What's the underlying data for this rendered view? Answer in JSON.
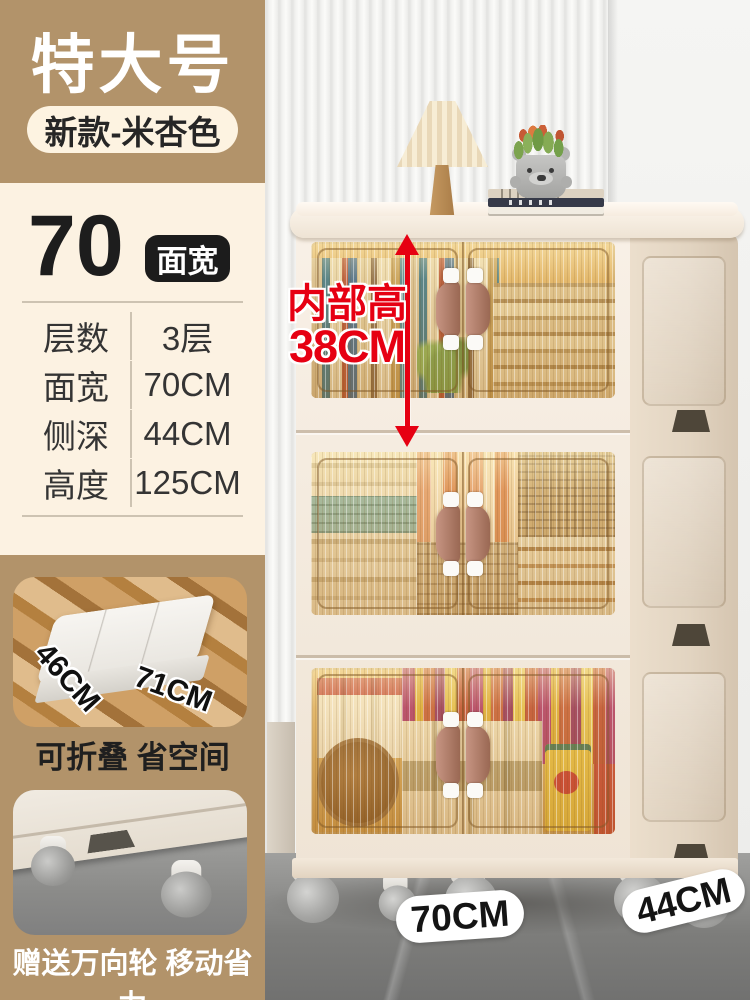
{
  "panel": {
    "size_label": "特大号",
    "variant_badge": "新款-米杏色",
    "width_number": "70",
    "width_badge": "面宽",
    "specs": [
      {
        "label": "层数",
        "value": "3层"
      },
      {
        "label": "面宽",
        "value": "70CM"
      },
      {
        "label": "侧深",
        "value": "44CM"
      },
      {
        "label": "高度",
        "value": "125CM"
      }
    ],
    "fold_feature": {
      "depth_label": "46CM",
      "width_label": "71CM",
      "caption": "可折叠 省空间"
    },
    "wheel_feature": {
      "caption": "赠送万向轮 移动省力"
    }
  },
  "scene": {
    "inner_height_line1": "内部高",
    "inner_height_line2": "38CM",
    "front_width_label": "70CM",
    "side_depth_label": "44CM"
  },
  "colors": {
    "tan": "#b2936a",
    "cream": "#fcf2e2",
    "badge_black": "#1c1c1c",
    "accent_red": "#e60012",
    "cabinet_cream": "#f5ece2",
    "window_amber": "#d8a85c",
    "handle_brown": "#ab7662"
  }
}
